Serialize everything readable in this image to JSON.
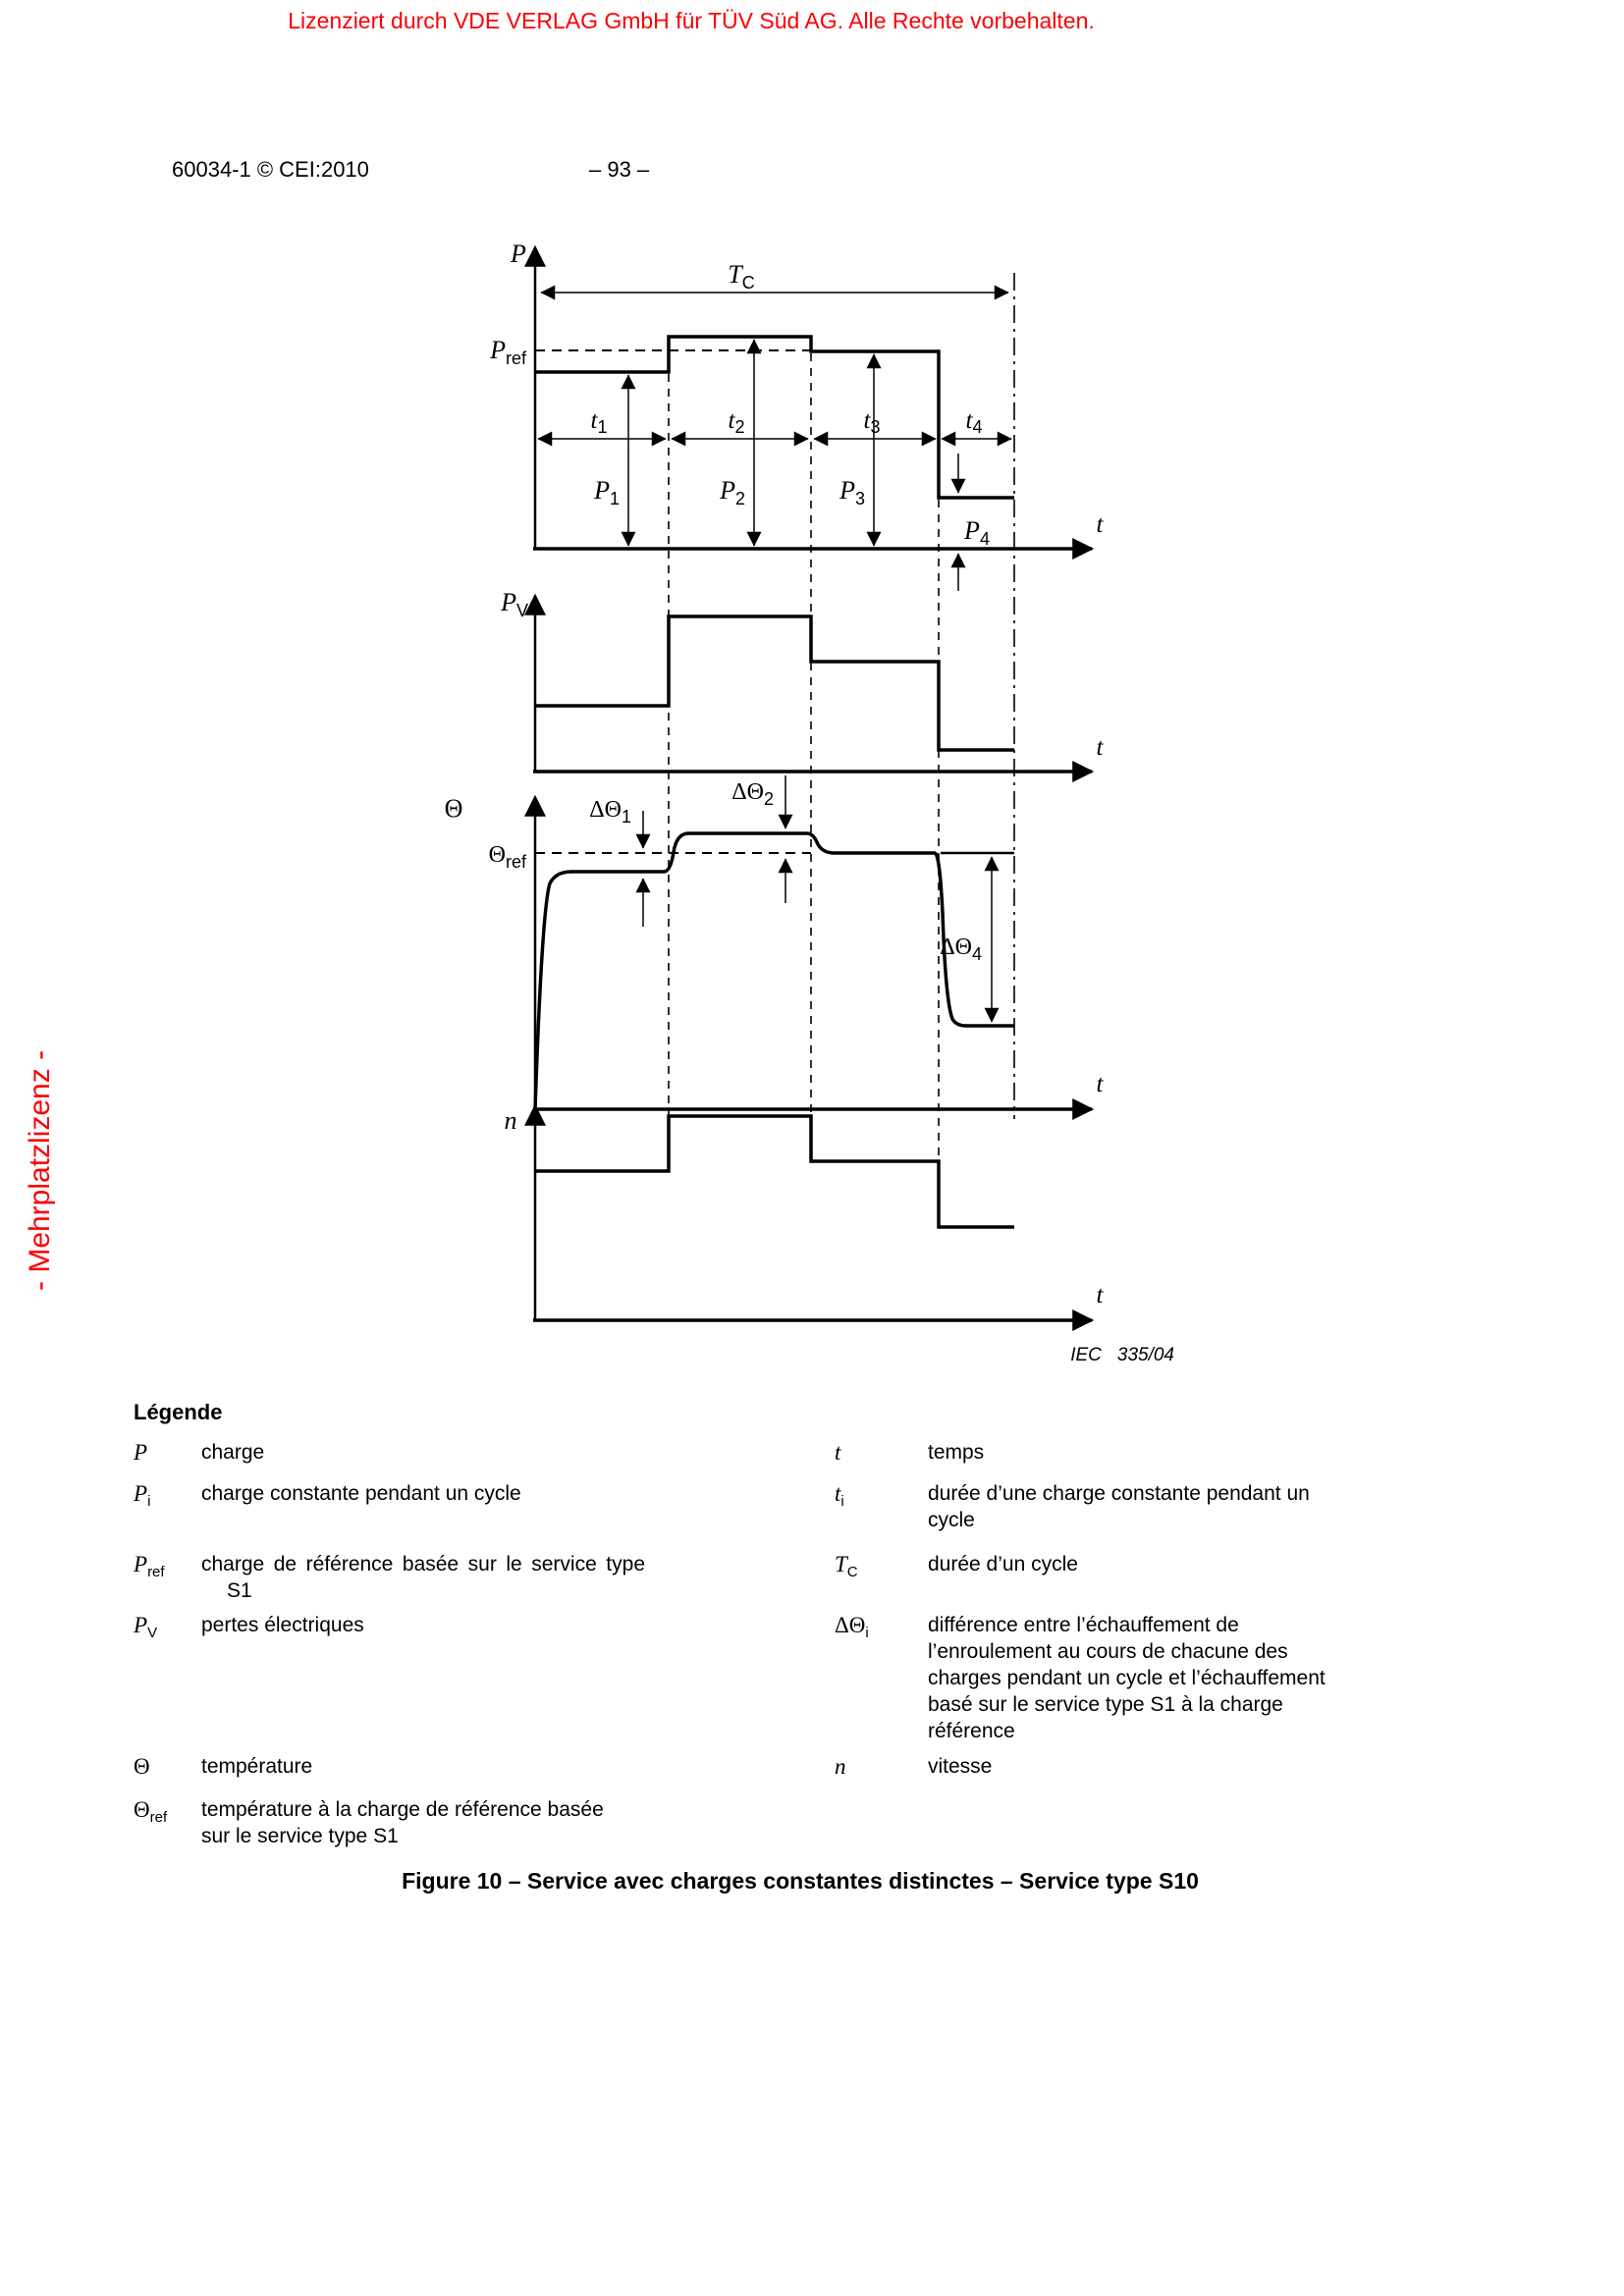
{
  "page": {
    "license_notice": "Lizenziert durch VDE VERLAG GmbH  für TÜV Süd AG. Alle Rechte vorbehalten.",
    "side_notice": "- Mehrplatzlizenz -",
    "doc_ref": "60034-1 © CEI:2010",
    "page_number": "– 93 –",
    "caption": "Figure 10 – Service avec charges constantes distinctes – Service type S10"
  },
  "figure": {
    "credit": {
      "org": "IEC",
      "num": "335/04"
    },
    "labels": {
      "p_axis": "P",
      "t": "t",
      "tc": {
        "main": "T",
        "sub": "C"
      },
      "p_ref": {
        "main": "P",
        "sub": "ref"
      },
      "t1": {
        "main": "t",
        "sub": "1"
      },
      "t2": {
        "main": "t",
        "sub": "2"
      },
      "t3": {
        "main": "t",
        "sub": "3"
      },
      "t4": {
        "main": "t",
        "sub": "4"
      },
      "p1": {
        "main": "P",
        "sub": "1"
      },
      "p2": {
        "main": "P",
        "sub": "2"
      },
      "p3": {
        "main": "P",
        "sub": "3"
      },
      "p4": {
        "main": "P",
        "sub": "4"
      },
      "pv_axis": {
        "main": "P",
        "sub": "V"
      },
      "theta_axis": "Θ",
      "theta_ref": {
        "main": "Θ",
        "sub": "ref"
      },
      "d1": {
        "main": "ΔΘ",
        "sub": "1"
      },
      "d2": {
        "main": "ΔΘ",
        "sub": "2"
      },
      "d4": {
        "main": "ΔΘ",
        "sub": "4"
      },
      "n_axis": "n"
    },
    "chart_data": [
      {
        "type": "line",
        "subtype": "step",
        "title": "P (charge) vs t",
        "x_segments": [
          "t1",
          "t2",
          "t3",
          "t4"
        ],
        "qualitative_levels": [
          "P1 below Pref",
          "P2 above Pref",
          "P3 about equal to Pref",
          "P4 low"
        ],
        "annotations": [
          "TC spans the full cycle t1+t2+t3+t4",
          "Pref shown as dashed reference line"
        ]
      },
      {
        "type": "line",
        "subtype": "step",
        "title": "PV (pertes électriques) vs t",
        "x_segments": [
          "t1",
          "t2",
          "t3",
          "t4"
        ],
        "qualitative_levels": [
          "medium",
          "high",
          "medium-low",
          "low"
        ]
      },
      {
        "type": "line",
        "subtype": "step",
        "title": "Θ (température) vs t",
        "x_segments": [
          "t1",
          "t2",
          "t3",
          "t4"
        ],
        "qualitative_levels": [
          "slightly below Θref",
          "above Θref",
          "about Θref",
          "far below Θref"
        ],
        "annotations": [
          "ΔΘ1 gap between Θref and level 1",
          "ΔΘ2 gap between level 2 and Θref",
          "ΔΘ4 gap between Θref and level 4",
          "Θref shown as dashed reference line"
        ]
      },
      {
        "type": "line",
        "subtype": "step",
        "title": "n (vitesse) vs t",
        "x_segments": [
          "t1",
          "t2",
          "t3",
          "t4"
        ],
        "qualitative_levels": [
          "medium",
          "high",
          "medium-low",
          "low"
        ]
      }
    ]
  },
  "legend": {
    "title": "Légende",
    "rows": [
      {
        "l_sym": "P",
        "l_text": "charge",
        "r_sym": "t",
        "r_text": "temps"
      },
      {
        "l_sym": "P",
        "l_sub": "i",
        "l_text": "charge constante pendant un cycle",
        "r_sym": "t",
        "r_sub": "i",
        "r_line1": "durée d’une charge constante pendant un",
        "r_line2": "cycle"
      },
      {
        "l_sym": "P",
        "l_sub": "ref",
        "l_line1": "charge de référence basée sur le service type",
        "l_line2": "S1",
        "r_sym": "T",
        "r_sub": "C",
        "r_text": "durée d’un cycle"
      },
      {
        "l_sym": "P",
        "l_sub": "V",
        "l_text": "pertes électriques",
        "r_sym": "ΔΘ",
        "r_sub": "i",
        "r_line1": "différence entre l’échauffement de",
        "r_line2": "l’enroulement au cours de chacune des",
        "r_line3": "charges pendant un cycle et l’échauffement",
        "r_line4": "basé sur le service type S1 à la charge",
        "r_line5": "référence"
      },
      {
        "l_sym": "Θ",
        "l_text": "température",
        "r_sym": "n",
        "r_text": "vitesse"
      },
      {
        "l_sym": "Θ",
        "l_sub": "ref",
        "l_line1": "température à la charge de référence basée",
        "l_line2": "sur le service type S1"
      }
    ]
  }
}
